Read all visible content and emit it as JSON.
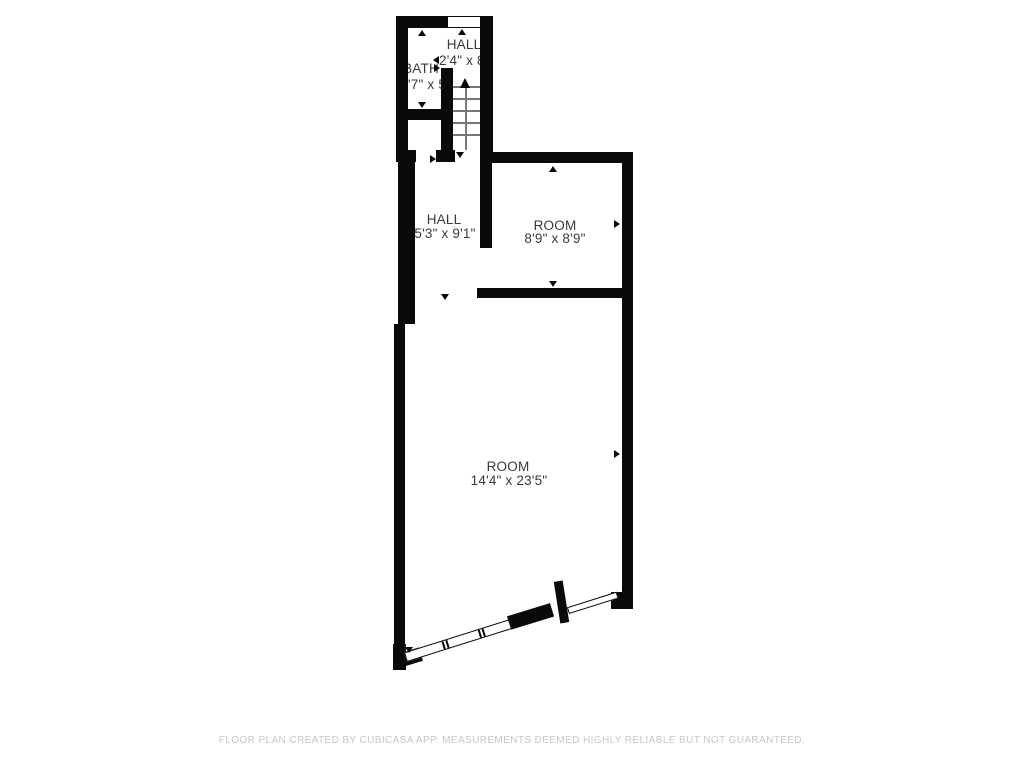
{
  "plan": {
    "type": "floor-plan",
    "rooms": {
      "bath": {
        "name": "BATH",
        "dims": "'7\" x 5'5\""
      },
      "hall_upper": {
        "name": "HALL",
        "dims": "2'4\" x 8'"
      },
      "hall": {
        "name": "HALL",
        "dims": "5'3\" x 9'1\""
      },
      "room_small": {
        "name": "ROOM",
        "dims": "8'9\" x 8'9\""
      },
      "room_large": {
        "name": "ROOM",
        "dims": "14'4\" x 23'5\""
      }
    },
    "features": [
      "staircase",
      "window-top",
      "window-strip-bottom",
      "door-bottom-right",
      "door-opening-hall",
      "door-opening-room"
    ]
  },
  "footer": {
    "disclaimer": "FLOOR PLAN CREATED BY CUBICASA APP. MEASUREMENTS DEEMED HIGHLY RELIABLE BUT NOT GUARANTEED."
  },
  "colors": {
    "wall": "#0a0a0a",
    "label": "#3a3a3a",
    "stair_lines": "#787878",
    "footer_text": "#c7c7c7",
    "background": "#ffffff"
  }
}
